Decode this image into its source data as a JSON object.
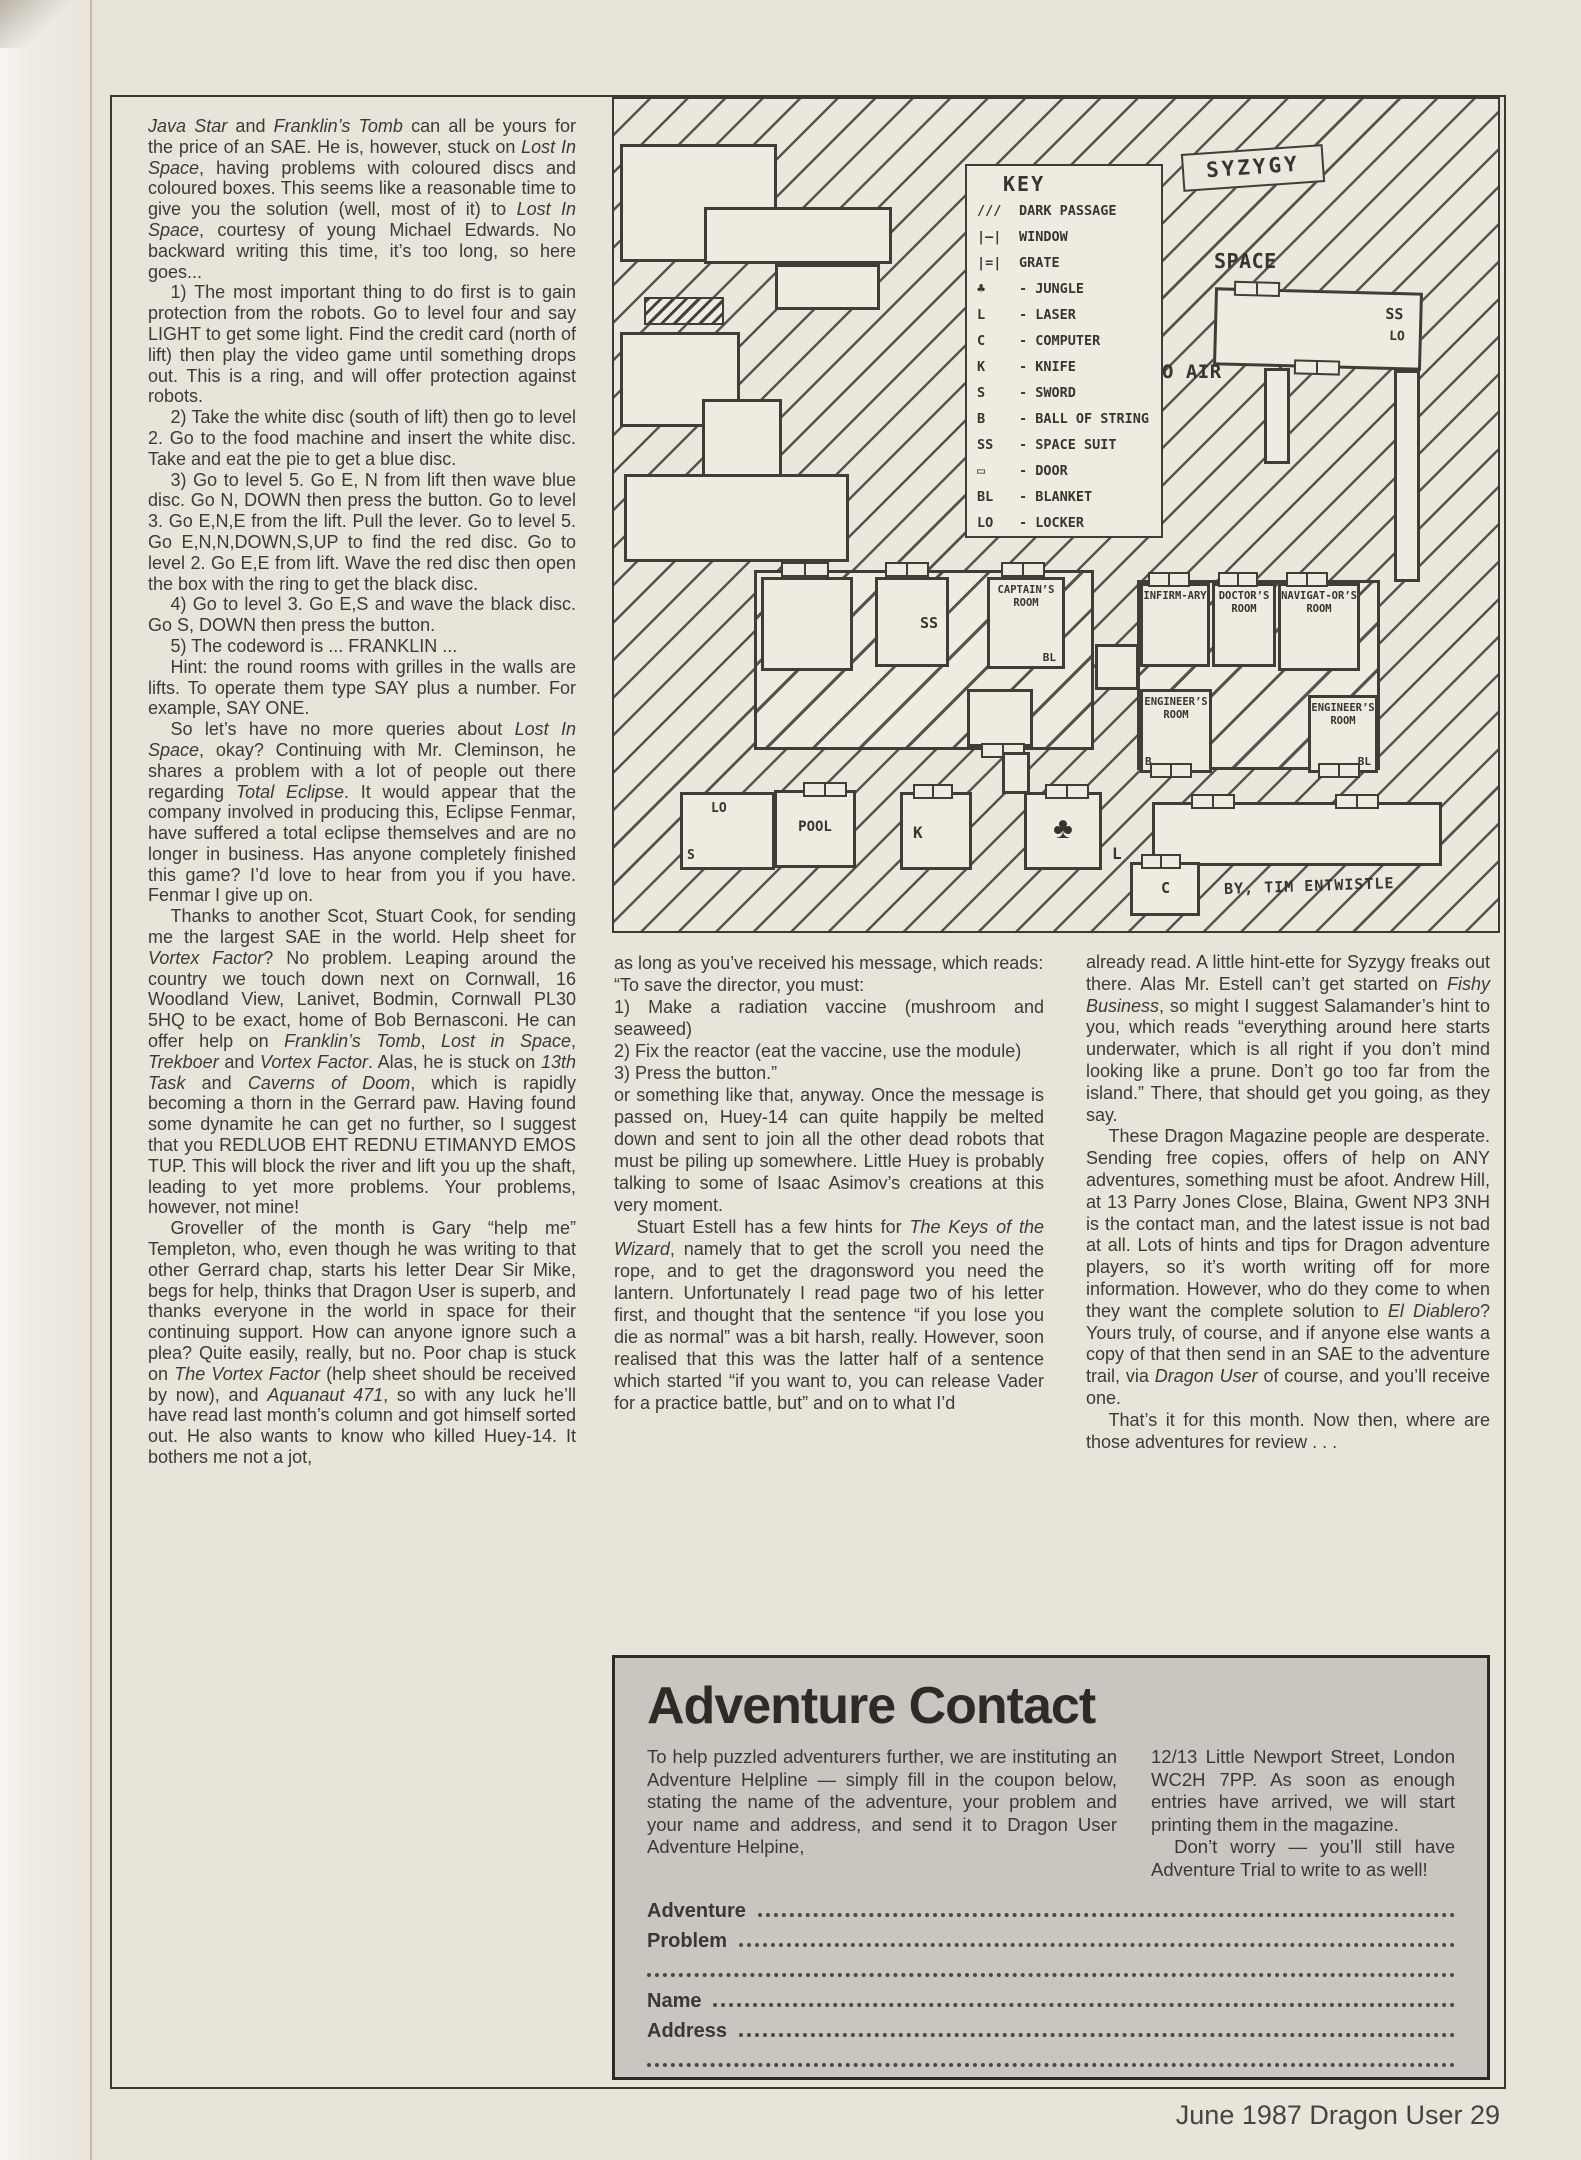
{
  "colors": {
    "paper": "#e8e4da",
    "ink": "#3d3a36",
    "coupon_gray": "#c9c6bf"
  },
  "page": {
    "footer": "June 1987 Dragon User 29"
  },
  "article": {
    "left_column": [
      {
        "t": "*Java Star* and *Franklin’s Tomb* can all be yours for the price of an SAE. He is, however, stuck on *Lost In Space*, having problems with coloured discs and coloured boxes. This seems like a reasonable time to give you the solution (well, most of it) to *Lost In Space*, courtesy of young Michael Edwards. No backward writing this time, it’s too long, so here goes...",
        "ind": false
      },
      {
        "t": "1) The most important thing to do first is to gain protection from the robots. Go to level four and say LIGHT to get some light. Find the credit card (north of lift) then play the video game until something drops out. This is a ring, and will offer protection against robots.",
        "ind": true
      },
      {
        "t": "2) Take the white disc (south of lift) then go to level 2. Go to the food machine and insert the white disc. Take and eat the pie to get a blue disc.",
        "ind": true
      },
      {
        "t": "3) Go to level 5. Go E, N from lift then wave blue disc. Go N, DOWN then press the button. Go to level 3. Go E,N,E from the lift. Pull the lever. Go to level 5. Go E,N,N,DOWN,S,UP to find the red disc. Go to level 2. Go E,E from lift. Wave the red disc then open the box with the ring to get the black disc.",
        "ind": true
      },
      {
        "t": "4) Go to level 3. Go E,S and wave the black disc. Go S, DOWN then press the button.",
        "ind": true
      },
      {
        "t": "5) The codeword is ... FRANKLIN ...",
        "ind": true
      },
      {
        "t": "Hint: the round rooms with grilles in the walls are lifts. To operate them type SAY plus a number. For example, SAY ONE.",
        "ind": true
      },
      {
        "t": "So let’s have no more queries about *Lost In Space*, okay? Continuing with Mr. Cleminson, he shares a problem with a lot of people out there regarding *Total Eclipse*. It would appear that the company involved in producing this, Eclipse Fenmar, have suffered a total eclipse themselves and are no longer in business. Has anyone completely finished this game? I’d love to hear from you if you have. Fenmar I give up on.",
        "ind": true
      },
      {
        "t": "Thanks to another Scot, Stuart Cook, for sending me the largest SAE in the world. Help sheet for *Vortex Factor*? No problem. Leaping around the country we touch down next on Cornwall, 16 Woodland View, Lanivet, Bodmin, Cornwall PL30 5HQ to be exact, home of Bob Bernasconi. He can offer help on *Franklin’s Tomb*, *Lost in Space*, *Trekboer* and *Vortex Factor*. Alas, he is stuck on *13th Task* and *Caverns of Doom*, which is rapidly becoming a thorn in the Gerrard paw. Having found some dynamite he can get no further, so I suggest that you REDLUOB EHT REDNU ETIMANYD EMOS TUP. This will block the river and lift you up the shaft, leading to yet more problems. Your problems, however, not mine!",
        "ind": true
      },
      {
        "t": "Groveller of the month is Gary “help me” Templeton, who, even though he was writing to that other Gerrard chap, starts his letter Dear Sir Mike, begs for help, thinks that Dragon User is superb, and thanks everyone in the world in space for their continuing support. How can anyone ignore such a plea? Quite easily, really, but no. Poor chap is stuck on *The Vortex Factor* (help sheet should be received by now), and *Aquanaut 471*, so with any luck he’ll have read last month’s column and got himself sorted out. He also wants to know who killed Huey-14. It bothers me not a jot,",
        "ind": true
      }
    ],
    "middle_column": [
      {
        "t": "as long as you’ve received his message, which reads:",
        "ind": false
      },
      {
        "t": "“To save the director, you must:",
        "ind": false
      },
      {
        "t": "1) Make a radiation vaccine (mushroom and seaweed)",
        "ind": false
      },
      {
        "t": "2) Fix the reactor (eat the vaccine, use the module)",
        "ind": false
      },
      {
        "t": "3) Press the button.”",
        "ind": false
      },
      {
        "t": "or something like that, anyway. Once the message is passed on, Huey-14 can quite happily be melted down and sent to join all the other dead robots that must be piling up somewhere. Little Huey is probably talking to some of Isaac Asimov’s creations at this very moment.",
        "ind": false
      },
      {
        "t": "Stuart Estell has a few hints for *The Keys of the Wizard*, namely that to get the scroll you need the rope, and to get the dragonsword you need the lantern. Unfortunately I read page two of his letter first, and thought that the sentence “if you lose you die as normal” was a bit harsh, really. However, soon realised that this was the latter half of a sentence which started “if you want to, you can release Vader for a practice battle, but” and on to what I’d",
        "ind": true
      }
    ],
    "right_column": [
      {
        "t": "already read. A little hint-ette for Syzygy freaks out there. Alas Mr. Estell can’t get started on *Fishy Business*, so might I suggest Salamander’s hint to you, which reads “everything around here starts underwater, which is all right if you don’t mind looking like a prune. Don’t go too far from the island.” There, that should get you going, as they say.",
        "ind": false
      },
      {
        "t": "These Dragon Magazine people are desperate. Sending free copies, offers of help on ANY adventures, something must be afoot. Andrew Hill, at 13 Parry Jones Close, Blaina, Gwent NP3 3NH is the contact man, and the latest issue is not bad at all. Lots of hints and tips for Dragon adventure players, so it’s worth writing off for more information. However, who do they come to when they want the complete solution to *El Diablero*? Yours truly, of course, and if anyone else wants a copy of that then send in an SAE to the adventure trail, via *Dragon User* of course, and you’ll receive one.",
        "ind": true
      },
      {
        "t": "That’s it for this month. Now then, where are those adventures for review . . .",
        "ind": true
      }
    ]
  },
  "map": {
    "title": "SYZYGY",
    "credit": "BY, TIM ENTWISTLE",
    "labels": {
      "space": "SPACE",
      "no_air": "NO AIR",
      "laser": "L"
    },
    "key": {
      "title": "KEY",
      "items": [
        {
          "sym": "///",
          "label": "DARK PASSAGE"
        },
        {
          "sym": "|—|",
          "label": "WINDOW"
        },
        {
          "sym": "|=|",
          "label": "GRATE"
        },
        {
          "sym": "♣",
          "label": "- JUNGLE"
        },
        {
          "sym": "L",
          "label": "- LASER"
        },
        {
          "sym": "C",
          "label": "- COMPUTER"
        },
        {
          "sym": "K",
          "label": "- KNIFE"
        },
        {
          "sym": "S",
          "label": "- SWORD"
        },
        {
          "sym": "B",
          "label": "- BALL OF STRING"
        },
        {
          "sym": "SS",
          "label": "- SPACE SUIT"
        },
        {
          "sym": "▭",
          "label": "- DOOR"
        },
        {
          "sym": "BL",
          "label": "- BLANKET"
        },
        {
          "sym": "LO",
          "label": "- LOCKER"
        }
      ]
    },
    "rooms": {
      "top_right_ss": "SS",
      "top_right_lo": "LO",
      "central_ss": "SS",
      "captains": "CAPTAIN’S ROOM",
      "captains_item": "BL",
      "infirmary": "INFIRM-ARY",
      "doctors": "DOCTOR’S ROOM",
      "navigators": "NAVIGAT-OR’S ROOM",
      "engineers_b": "ENGINEER’S ROOM",
      "engineers_b_item": "B",
      "engineers_bl": "ENGINEER’S ROOM",
      "engineers_bl_item": "BL",
      "locker_lo": "LO",
      "locker_s": "S",
      "pool": "POOL",
      "knife": "K",
      "computer": "C"
    }
  },
  "adventure_contact": {
    "title": "Adventure Contact",
    "intro_left": "To help puzzled adventurers further, we are instituting an Adventure Helpline — simply fill in the coupon below, stating the name of the adventure, your problem and your name and address, and send it to Dragon User Adventure Helpine,",
    "intro_right": [
      {
        "t": "12/13 Little Newport Street, London WC2H 7PP. As soon as enough entries have arrived, we will start printing them in the magazine.",
        "ind": false
      },
      {
        "t": "Don’t worry — you’ll still have Adventure Trial to write to as well!",
        "ind": true
      }
    ],
    "coupon_rows": [
      {
        "label": "Adventure"
      },
      {
        "label": "Problem"
      },
      {
        "label": ""
      },
      {
        "label": "Name"
      },
      {
        "label": "Address"
      },
      {
        "label": ""
      }
    ]
  }
}
